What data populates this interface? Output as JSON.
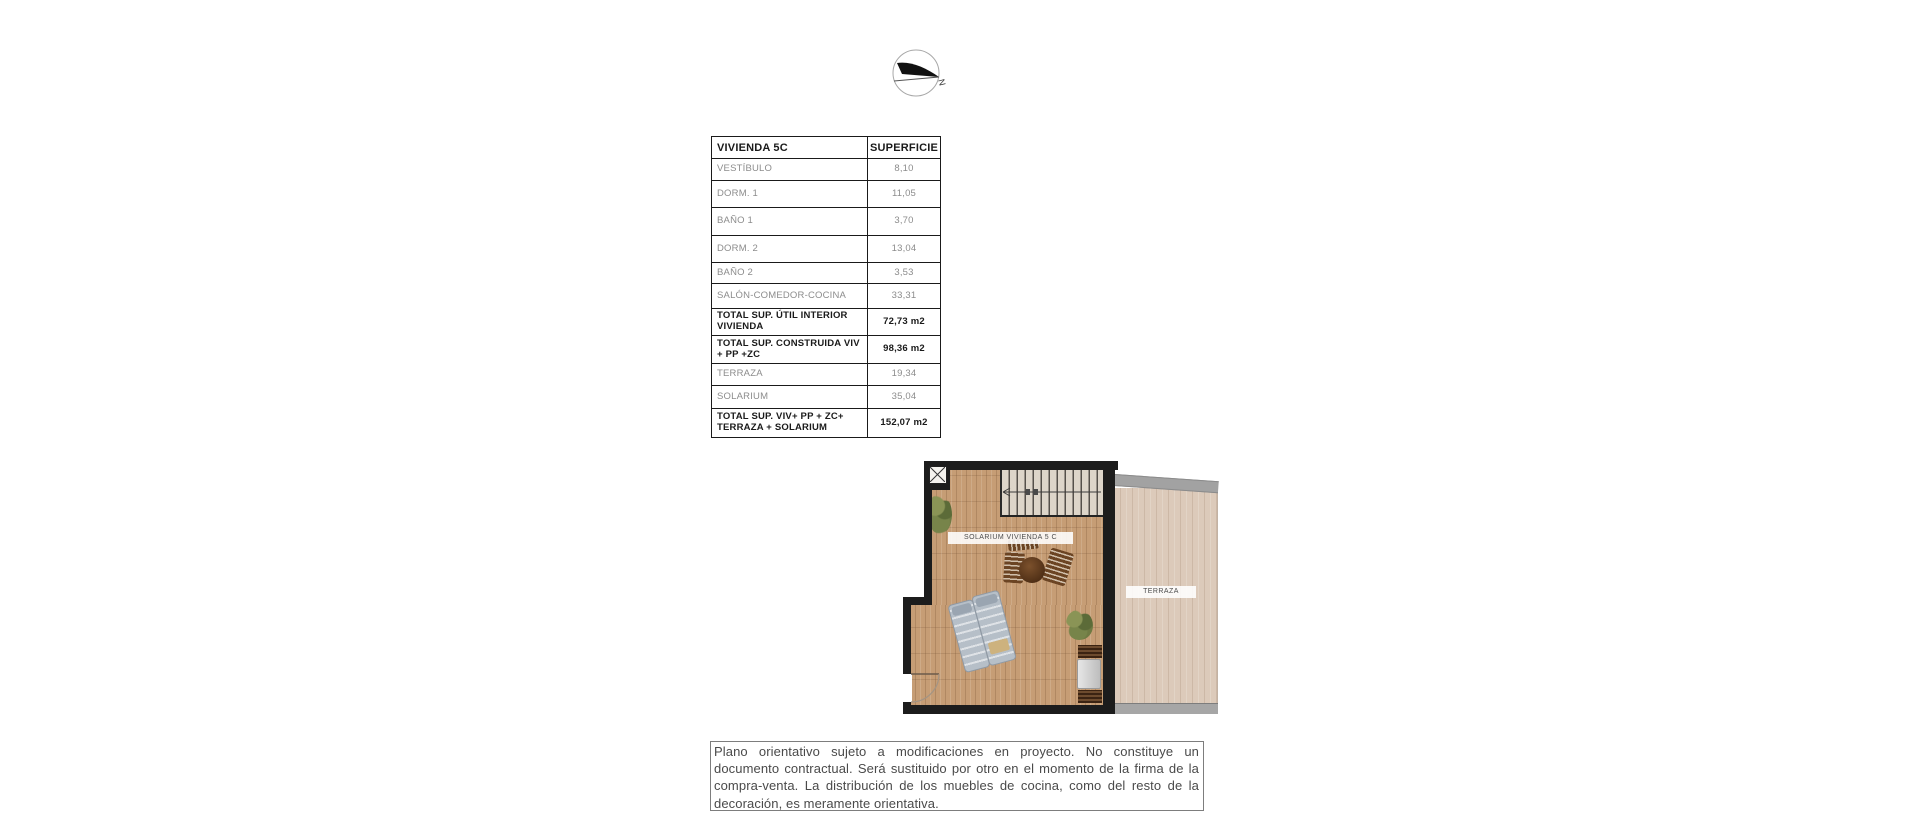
{
  "compass": {
    "north_label": "N"
  },
  "area_table": {
    "title": "VIVIENDA 5C",
    "surface_header": "SUPERFICIE",
    "rows": [
      {
        "label": "VESTÍBULO",
        "value": "8,10"
      },
      {
        "label": "DORM. 1",
        "value": "11,05"
      },
      {
        "label": "BAÑO 1",
        "value": "3,70"
      },
      {
        "label": "DORM. 2",
        "value": "13,04"
      },
      {
        "label": "BAÑO 2",
        "value": "3,53"
      },
      {
        "label": "SALÓN-COMEDOR-COCINA",
        "value": "33,31"
      },
      {
        "label": "TOTAL SUP. ÚTIL INTERIOR VIVIENDA",
        "value": "72,73 m2"
      },
      {
        "label": "TOTAL SUP. CONSTRUIDA VIV + PP +ZC",
        "value": "98,36 m2"
      },
      {
        "label": "TERRAZA",
        "value": "19,34"
      },
      {
        "label": "SOLARIUM",
        "value": "35,04"
      },
      {
        "label": "TOTAL SUP. VIV+ PP + ZC+ TERRAZA + SOLARIUM",
        "value": "152,07 m2"
      }
    ]
  },
  "floor_plan": {
    "solarium_label": "SOLARIUM VIVIENDA 5 C",
    "terrace_label": "TERRAZA",
    "colors": {
      "wall": "#1c1c1c",
      "solarium_floor": "#c69d75",
      "terrace_floor": "#dccaba",
      "concrete_strip": "#a2a2a2",
      "furniture_wood": "#5f3d22",
      "lounger": "#b6bfc8",
      "plant_green": "#6f7a43"
    }
  },
  "disclaimer": {
    "text": "Plano orientativo sujeto a modificaciones en proyecto. No constituye un documento contractual. Será sustituido por otro en el momento de la firma de la compra-venta. La distribución de los muebles de cocina, como del resto de la decoración, es meramente orientativa."
  }
}
